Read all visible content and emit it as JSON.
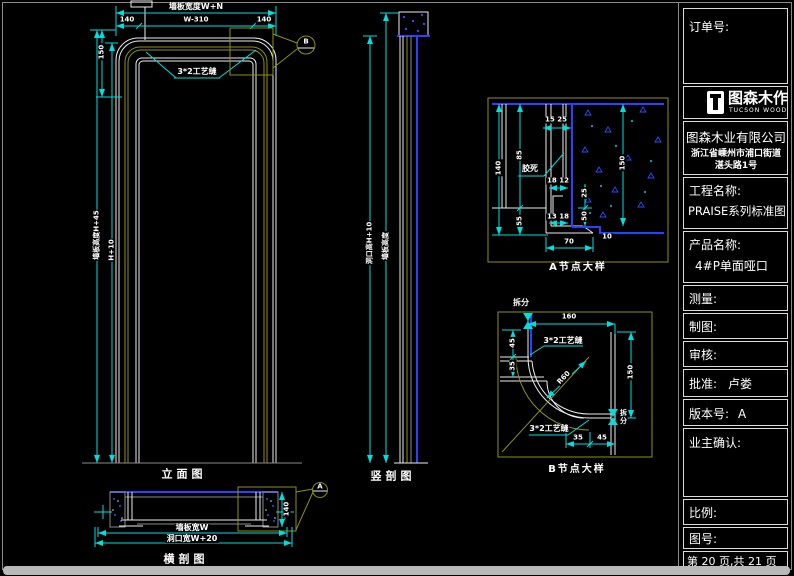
{
  "titleblock": {
    "order_label": "订单号:",
    "logo_title": "图森木作",
    "logo_sub": "TUCSON WOOD",
    "company": "图森木业有限公司",
    "address_line1": "浙江省嵊州市浦口街道",
    "address_line2": "湛头路1号",
    "project_label": "工程名称:",
    "project_value": "PRAISE系列标准图",
    "product_label": "产品名称:",
    "product_value": "4#P单面哑口",
    "measure_label": "测量:",
    "draft_label": "制图:",
    "review_label": "审核:",
    "approve_label": "批准:",
    "approve_value": "卢娄",
    "version_label": "版本号:",
    "version_value": "A",
    "owner_confirm_label": "业主确认:",
    "scale_label": "比例:",
    "drawing_no_label": "图号:",
    "page_info": "第 20 页,共 21 页"
  },
  "views": {
    "elevation": {
      "title": "立面图",
      "dim_total": "墙板宽度W+N",
      "dim_seg_left": "140",
      "dim_seg_mid": "W-310",
      "dim_seg_right": "140",
      "dim_head": "150",
      "dim_height_outer": "墙板高度H+45",
      "dim_height_inner": "H+10",
      "note_groove": "3*2工艺缝",
      "marker": "B"
    },
    "vsection": {
      "title": "竖剖图",
      "dim_opening": "洞口高H+10",
      "dim_board": "墙板高度"
    },
    "hsection": {
      "title": "横剖图",
      "dim_board_width": "墙板宽W",
      "dim_opening_width": "洞口宽W+20",
      "dim_thickness": "140",
      "marker": "A"
    },
    "detail_a": {
      "title": "A节点大样",
      "note_glue": "胶死",
      "dim_15_25": "15 25",
      "dim_18_12": "18 12",
      "dim_13_18": "13 18",
      "dim_70": "70",
      "dim_140": "140",
      "dim_85": "85",
      "dim_55": "55",
      "dim_150": "150",
      "dim_25": "25",
      "dim_50": "50",
      "dim_10": "10"
    },
    "detail_b": {
      "title": "B节点大样",
      "split_top": "拆分",
      "split_right": "拆分",
      "dim_160": "160",
      "dim_45_left": "45",
      "dim_35_left": "35",
      "dim_150": "150",
      "dim_35_bottom": "35",
      "dim_45_bottom": "45",
      "radius": "R60",
      "note_groove_1": "3*2工艺缝",
      "note_groove_2": "3*2工艺缝"
    }
  }
}
